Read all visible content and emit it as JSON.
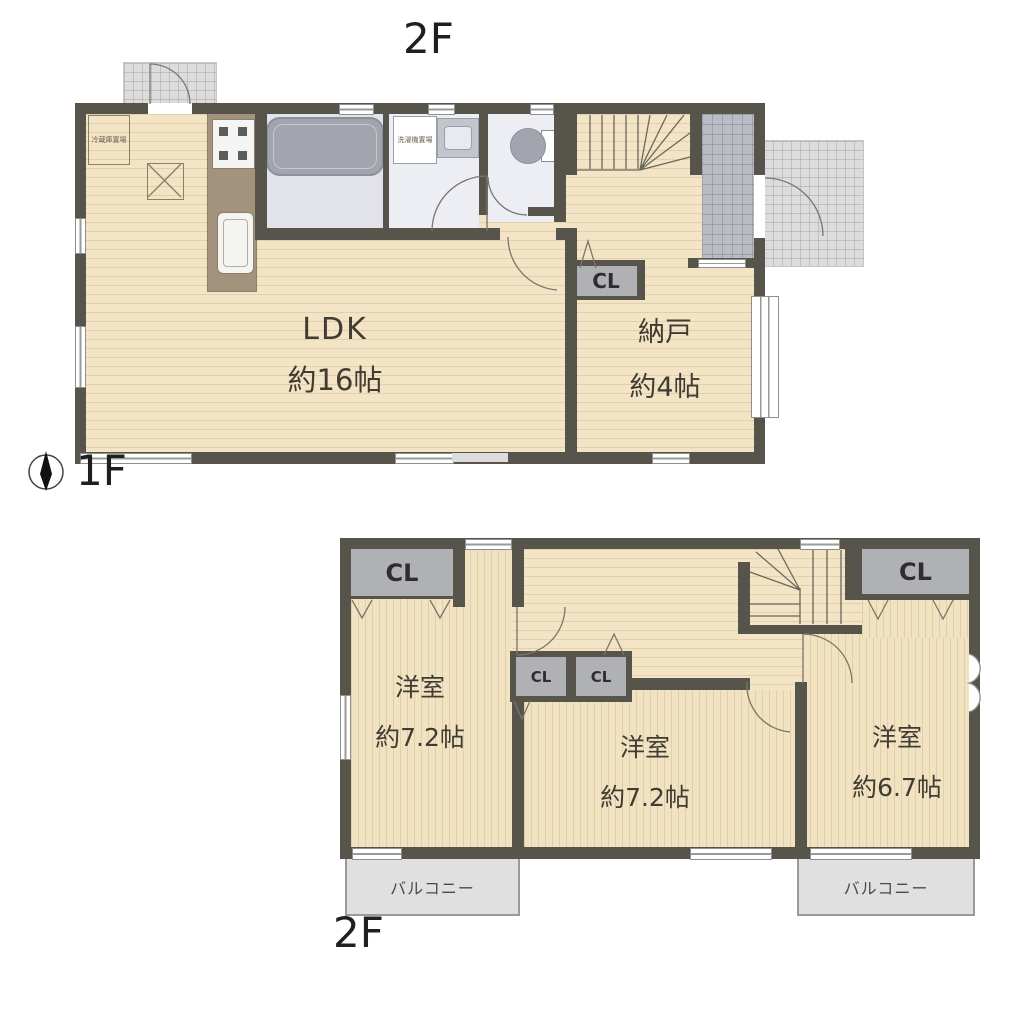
{
  "titles": {
    "top_floor_label": "2F",
    "floor1_label": "1F",
    "floor2_label": "2F"
  },
  "floor1": {
    "rooms": {
      "ldk": {
        "name": "LDK",
        "size": "約16帖"
      },
      "storage": {
        "name": "納戸",
        "size": "約4帖"
      }
    },
    "closet_label": "CL",
    "fridge_label": "冷蔵庫置場",
    "washer_label": "洗濯機置場"
  },
  "floor2": {
    "rooms": {
      "west": {
        "name": "洋室",
        "size": "約7.2帖"
      },
      "center": {
        "name": "洋室",
        "size": "約7.2帖"
      },
      "east": {
        "name": "洋室",
        "size": "約6.7帖"
      }
    },
    "closet_labels": [
      "CL",
      "CL",
      "CL",
      "CL"
    ],
    "balcony_label": "バルコニー"
  },
  "colors": {
    "wall": "#57544C",
    "floor_beige": "#F2E4C4",
    "closet_gray": "#B0B1B4",
    "wet_area_floor": "#EDEEF3",
    "bathroom_floor": "#E2E3EA",
    "fixture_gray": "#A2A5AE",
    "kitchen_counter": "#A3927C",
    "entrance_tile": "#B9BCC3",
    "porch_gray": "#DCDCDC",
    "balcony_gray": "#E0E0E0",
    "text_dark": "#403C33"
  }
}
